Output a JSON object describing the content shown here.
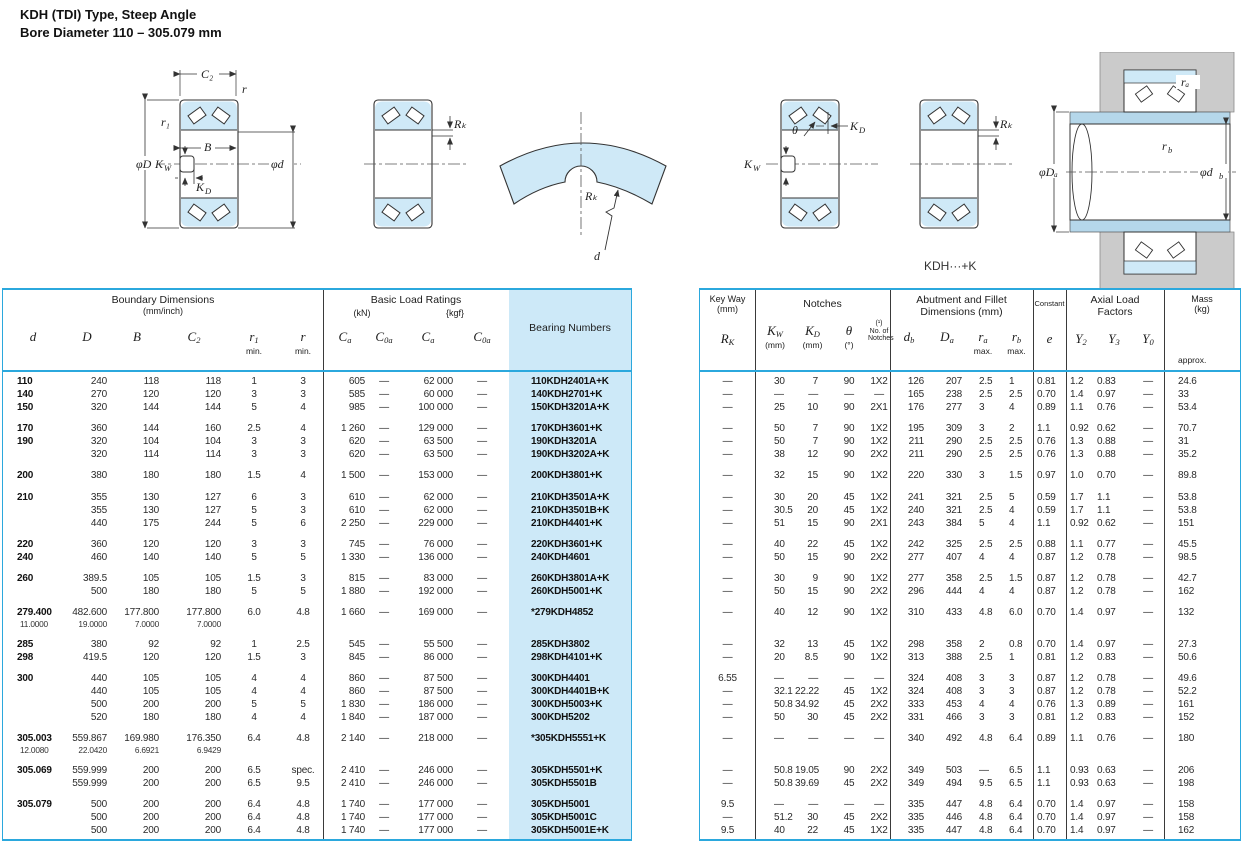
{
  "title": {
    "line1": "KDH (TDI) Type, Steep Angle",
    "line2": "Bore Diameter   110 – 305.079 mm"
  },
  "diagrams": {
    "c2": "C₂",
    "r": "r",
    "r1": "r₁",
    "phiD": "φD",
    "b": "B",
    "phid": "φd",
    "kw_base": "K",
    "kw_sub": "W",
    "kd_base": "K",
    "kd_sub": "D",
    "rk": "Rₖ",
    "d": "d",
    "theta": "θ",
    "ra": "rₐ",
    "rb_base": "r",
    "rb_sub": "b",
    "phiDa": "φDₐ",
    "phidb_base": "φd",
    "phidb_sub": "b",
    "caption": "KDH···+K"
  },
  "left_header": {
    "group1": "Boundary Dimensions",
    "group1_unit": "(mm/inch)",
    "group2": "Basic Load Ratings",
    "unit_kn": "(kN)",
    "unit_kgf": "{kgf}",
    "group3": "Bearing Numbers",
    "sym_d": "d",
    "sym_D": "D",
    "sym_B": "B",
    "sym_C": "C",
    "sub_2": "2",
    "sym_r": "r",
    "sub_1": "1",
    "min": "min.",
    "sub_a": "a",
    "sub_0a": "0a"
  },
  "right_header": {
    "keyway": "Key Way",
    "keyway_unit": "(mm)",
    "sym_R": "R",
    "sub_K": "K",
    "notches": "Notches",
    "sym_K": "K",
    "sub_W": "W",
    "sub_D": "D",
    "unit_mm": "(mm)",
    "sym_theta": "θ",
    "unit_deg": "(°)",
    "fn": "(¹)",
    "noof": "No. of",
    "noof2": "Notches",
    "abut1": "Abutment and Fillet",
    "abut2": "Dimensions (mm)",
    "sym_db": "d",
    "sub_b": "b",
    "sym_Da": "D",
    "sub_a": "a",
    "sym_r": "r",
    "max": "max.",
    "constant": "Constant",
    "sym_e": "e",
    "axial1": "Axial Load",
    "axial2": "Factors",
    "sym_Y": "Y",
    "sub_y2": "2",
    "sub_y3": "3",
    "sub_y0": "0",
    "mass": "Mass",
    "mass_unit": "(kg)",
    "approx": "approx."
  },
  "groups": [
    {
      "rows": [
        {
          "l": [
            "110",
            "240",
            "118",
            "118",
            "1",
            "3",
            "605",
            "—",
            "62 000",
            "—",
            "110KDH2401A+K"
          ],
          "r": [
            "—",
            "30",
            "7",
            "90",
            "1X2",
            "126",
            "207",
            "2.5",
            "1",
            "0.81",
            "1.2",
            "0.83",
            "—",
            "24.6"
          ]
        },
        {
          "l": [
            "140",
            "270",
            "120",
            "120",
            "3",
            "3",
            "585",
            "—",
            "60 000",
            "—",
            "140KDH2701+K"
          ],
          "r": [
            "—",
            "—",
            "—",
            "—",
            "—",
            "165",
            "238",
            "2.5",
            "2.5",
            "0.70",
            "1.4",
            "0.97",
            "—",
            "33"
          ]
        },
        {
          "l": [
            "150",
            "320",
            "144",
            "144",
            "5",
            "4",
            "985",
            "—",
            "100 000",
            "—",
            "150KDH3201A+K"
          ],
          "r": [
            "—",
            "25",
            "10",
            "90",
            "2X1",
            "176",
            "277",
            "3",
            "4",
            "0.89",
            "1.1",
            "0.76",
            "—",
            "53.4"
          ]
        }
      ]
    },
    {
      "rows": [
        {
          "l": [
            "170",
            "360",
            "144",
            "160",
            "2.5",
            "4",
            "1 260",
            "—",
            "129 000",
            "—",
            "170KDH3601+K"
          ],
          "r": [
            "—",
            "50",
            "7",
            "90",
            "1X2",
            "195",
            "309",
            "3",
            "2",
            "1.1",
            "0.92",
            "0.62",
            "—",
            "70.7"
          ]
        },
        {
          "l": [
            "190",
            "320",
            "104",
            "104",
            "3",
            "3",
            "620",
            "—",
            "63 500",
            "—",
            "190KDH3201A"
          ],
          "r": [
            "—",
            "50",
            "7",
            "90",
            "1X2",
            "211",
            "290",
            "2.5",
            "2.5",
            "0.76",
            "1.3",
            "0.88",
            "—",
            "31"
          ]
        },
        {
          "l": [
            "",
            "320",
            "114",
            "114",
            "3",
            "3",
            "620",
            "—",
            "63 500",
            "—",
            "190KDH3202A+K"
          ],
          "r": [
            "—",
            "38",
            "12",
            "90",
            "2X2",
            "211",
            "290",
            "2.5",
            "2.5",
            "0.76",
            "1.3",
            "0.88",
            "—",
            "35.2"
          ]
        }
      ]
    },
    {
      "rows": [
        {
          "l": [
            "200",
            "380",
            "180",
            "180",
            "1.5",
            "4",
            "1 500",
            "—",
            "153 000",
            "—",
            "200KDH3801+K"
          ],
          "r": [
            "—",
            "32",
            "15",
            "90",
            "1X2",
            "220",
            "330",
            "3",
            "1.5",
            "0.97",
            "1.0",
            "0.70",
            "—",
            "89.8"
          ]
        }
      ]
    },
    {
      "rows": [
        {
          "l": [
            "210",
            "355",
            "130",
            "127",
            "6",
            "3",
            "610",
            "—",
            "62 000",
            "—",
            "210KDH3501A+K"
          ],
          "r": [
            "—",
            "30",
            "20",
            "45",
            "1X2",
            "241",
            "321",
            "2.5",
            "5",
            "0.59",
            "1.7",
            "1.1",
            "—",
            "53.8"
          ]
        },
        {
          "l": [
            "",
            "355",
            "130",
            "127",
            "5",
            "3",
            "610",
            "—",
            "62 000",
            "—",
            "210KDH3501B+K"
          ],
          "r": [
            "—",
            "30.5",
            "20",
            "45",
            "1X2",
            "240",
            "321",
            "2.5",
            "4",
            "0.59",
            "1.7",
            "1.1",
            "—",
            "53.8"
          ]
        },
        {
          "l": [
            "",
            "440",
            "175",
            "244",
            "5",
            "6",
            "2 250",
            "—",
            "229 000",
            "—",
            "210KDH4401+K"
          ],
          "r": [
            "—",
            "51",
            "15",
            "90",
            "2X1",
            "243",
            "384",
            "5",
            "4",
            "1.1",
            "0.92",
            "0.62",
            "—",
            "151"
          ]
        }
      ]
    },
    {
      "rows": [
        {
          "l": [
            "220",
            "360",
            "120",
            "120",
            "3",
            "3",
            "745",
            "—",
            "76 000",
            "—",
            "220KDH3601+K"
          ],
          "r": [
            "—",
            "40",
            "22",
            "45",
            "1X2",
            "242",
            "325",
            "2.5",
            "2.5",
            "0.88",
            "1.1",
            "0.77",
            "—",
            "45.5"
          ]
        },
        {
          "l": [
            "240",
            "460",
            "140",
            "140",
            "5",
            "5",
            "1 330",
            "—",
            "136 000",
            "—",
            "240KDH4601"
          ],
          "r": [
            "—",
            "50",
            "15",
            "90",
            "2X2",
            "277",
            "407",
            "4",
            "4",
            "0.87",
            "1.2",
            "0.78",
            "—",
            "98.5"
          ]
        }
      ]
    },
    {
      "rows": [
        {
          "l": [
            "260",
            "389.5",
            "105",
            "105",
            "1.5",
            "3",
            "815",
            "—",
            "83 000",
            "—",
            "260KDH3801A+K"
          ],
          "r": [
            "—",
            "30",
            "9",
            "90",
            "1X2",
            "277",
            "358",
            "2.5",
            "1.5",
            "0.87",
            "1.2",
            "0.78",
            "—",
            "42.7"
          ]
        },
        {
          "l": [
            "",
            "500",
            "180",
            "180",
            "5",
            "5",
            "1 880",
            "—",
            "192 000",
            "—",
            "260KDH5001+K"
          ],
          "r": [
            "—",
            "50",
            "15",
            "90",
            "2X2",
            "296",
            "444",
            "4",
            "4",
            "0.87",
            "1.2",
            "0.78",
            "—",
            "162"
          ]
        }
      ]
    },
    {
      "rows": [
        {
          "l": [
            "279.400",
            "482.600",
            "177.800",
            "177.800",
            "6.0",
            "4.8",
            "1 660",
            "—",
            "169 000",
            "—",
            "*279KDH4852"
          ],
          "inch": [
            "11.0000",
            "19.0000",
            "7.0000",
            "7.0000"
          ],
          "r": [
            "—",
            "40",
            "12",
            "90",
            "1X2",
            "310",
            "433",
            "4.8",
            "6.0",
            "0.70",
            "1.4",
            "0.97",
            "—",
            "132"
          ]
        }
      ]
    },
    {
      "rows": [
        {
          "l": [
            "285",
            "380",
            "92",
            "92",
            "1",
            "2.5",
            "545",
            "—",
            "55 500",
            "—",
            "285KDH3802"
          ],
          "r": [
            "—",
            "32",
            "13",
            "45",
            "1X2",
            "298",
            "358",
            "2",
            "0.8",
            "0.70",
            "1.4",
            "0.97",
            "—",
            "27.3"
          ]
        },
        {
          "l": [
            "298",
            "419.5",
            "120",
            "120",
            "1.5",
            "3",
            "845",
            "—",
            "86 000",
            "—",
            "298KDH4101+K"
          ],
          "r": [
            "—",
            "20",
            "8.5",
            "90",
            "1X2",
            "313",
            "388",
            "2.5",
            "1",
            "0.81",
            "1.2",
            "0.83",
            "—",
            "50.6"
          ]
        }
      ]
    },
    {
      "rows": [
        {
          "l": [
            "300",
            "440",
            "105",
            "105",
            "4",
            "4",
            "860",
            "—",
            "87 500",
            "—",
            "300KDH4401"
          ],
          "r": [
            "6.55",
            "—",
            "—",
            "—",
            "—",
            "324",
            "408",
            "3",
            "3",
            "0.87",
            "1.2",
            "0.78",
            "—",
            "49.6"
          ]
        },
        {
          "l": [
            "",
            "440",
            "105",
            "105",
            "4",
            "4",
            "860",
            "—",
            "87 500",
            "—",
            "300KDH4401B+K"
          ],
          "r": [
            "—",
            "32.1",
            "22.22",
            "45",
            "1X2",
            "324",
            "408",
            "3",
            "3",
            "0.87",
            "1.2",
            "0.78",
            "—",
            "52.2"
          ]
        },
        {
          "l": [
            "",
            "500",
            "200",
            "200",
            "5",
            "5",
            "1 830",
            "—",
            "186 000",
            "—",
            "300KDH5003+K"
          ],
          "r": [
            "—",
            "50.8",
            "34.92",
            "45",
            "2X2",
            "333",
            "453",
            "4",
            "4",
            "0.76",
            "1.3",
            "0.89",
            "—",
            "161"
          ]
        },
        {
          "l": [
            "",
            "520",
            "180",
            "180",
            "4",
            "4",
            "1 840",
            "—",
            "187 000",
            "—",
            "300KDH5202"
          ],
          "r": [
            "—",
            "50",
            "30",
            "45",
            "2X2",
            "331",
            "466",
            "3",
            "3",
            "0.81",
            "1.2",
            "0.83",
            "—",
            "152"
          ]
        }
      ]
    },
    {
      "rows": [
        {
          "l": [
            "305.003",
            "559.867",
            "169.980",
            "176.350",
            "6.4",
            "4.8",
            "2 140",
            "—",
            "218 000",
            "—",
            "*305KDH5551+K"
          ],
          "inch": [
            "12.0080",
            "22.0420",
            "6.6921",
            "6.9429"
          ],
          "r": [
            "—",
            "—",
            "—",
            "—",
            "—",
            "340",
            "492",
            "4.8",
            "6.4",
            "0.89",
            "1.1",
            "0.76",
            "—",
            "180"
          ]
        }
      ]
    },
    {
      "rows": [
        {
          "l": [
            "305.069",
            "559.999",
            "200",
            "200",
            "6.5",
            "spec.",
            "2 410",
            "—",
            "246 000",
            "—",
            "305KDH5501+K"
          ],
          "r": [
            "—",
            "50.8",
            "19.05",
            "90",
            "2X2",
            "349",
            "503",
            "—",
            "6.5",
            "1.1",
            "0.93",
            "0.63",
            "—",
            "206"
          ]
        },
        {
          "l": [
            "",
            "559.999",
            "200",
            "200",
            "6.5",
            "9.5",
            "2 410",
            "—",
            "246 000",
            "—",
            "305KDH5501B"
          ],
          "r": [
            "—",
            "50.8",
            "39.69",
            "45",
            "2X2",
            "349",
            "494",
            "9.5",
            "6.5",
            "1.1",
            "0.93",
            "0.63",
            "—",
            "198"
          ]
        }
      ]
    },
    {
      "rows": [
        {
          "l": [
            "305.079",
            "500",
            "200",
            "200",
            "6.4",
            "4.8",
            "1 740",
            "—",
            "177 000",
            "—",
            "305KDH5001"
          ],
          "r": [
            "9.5",
            "—",
            "—",
            "—",
            "—",
            "335",
            "447",
            "4.8",
            "6.4",
            "0.70",
            "1.4",
            "0.97",
            "—",
            "158"
          ]
        },
        {
          "l": [
            "",
            "500",
            "200",
            "200",
            "6.4",
            "4.8",
            "1 740",
            "—",
            "177 000",
            "—",
            "305KDH5001C"
          ],
          "r": [
            "—",
            "51.2",
            "30",
            "45",
            "2X2",
            "335",
            "446",
            "4.8",
            "6.4",
            "0.70",
            "1.4",
            "0.97",
            "—",
            "158"
          ]
        },
        {
          "l": [
            "",
            "500",
            "200",
            "200",
            "6.4",
            "4.8",
            "1 740",
            "—",
            "177 000",
            "—",
            "305KDH5001E+K"
          ],
          "r": [
            "9.5",
            "40",
            "22",
            "45",
            "1X2",
            "335",
            "447",
            "4.8",
            "6.4",
            "0.70",
            "1.4",
            "0.97",
            "—",
            "162"
          ]
        }
      ]
    }
  ]
}
